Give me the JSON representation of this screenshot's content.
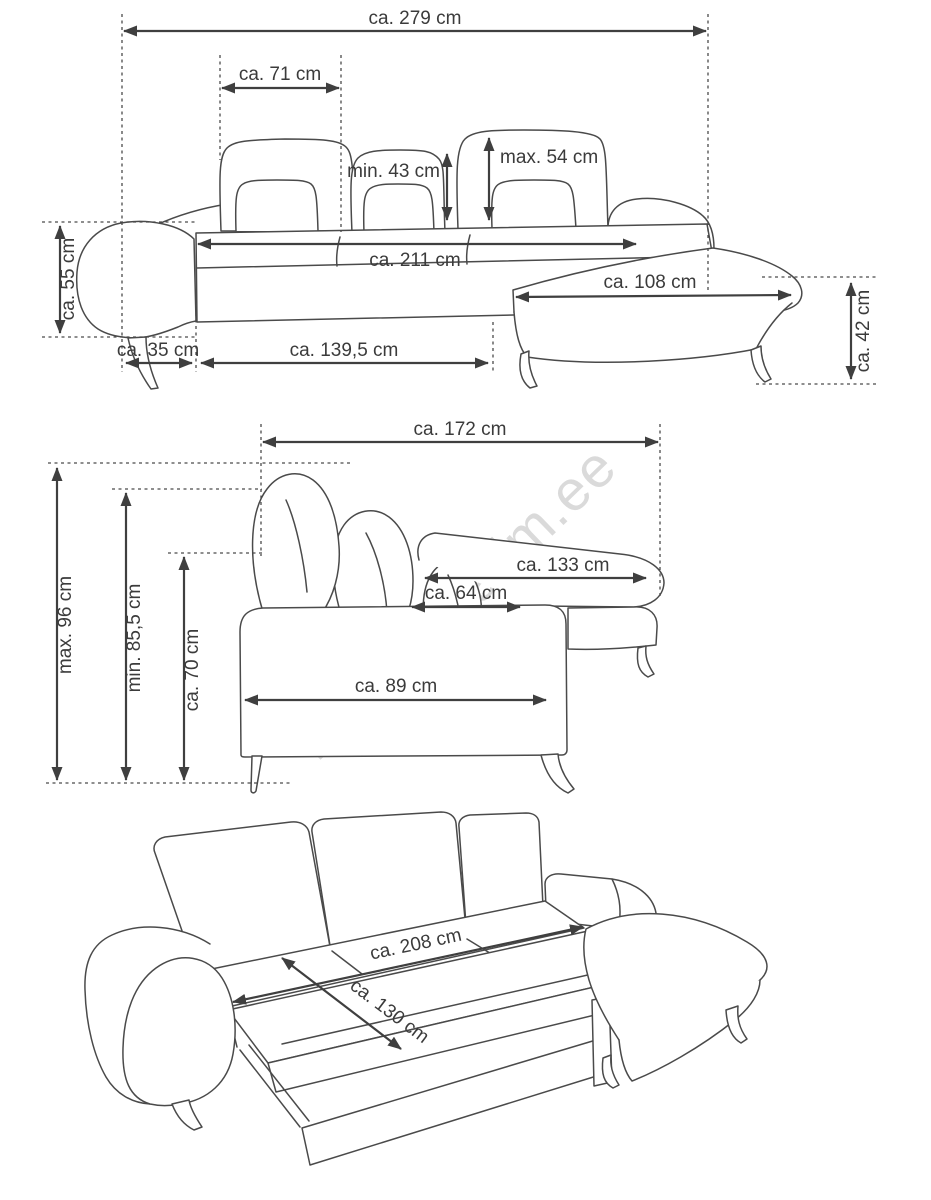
{
  "watermark": {
    "text": "lambimaailm.ee"
  },
  "colors": {
    "background": "#ffffff",
    "line": "#4a4a4a",
    "dimension_arrow": "#3f3f3f",
    "text": "#3b3b3b",
    "watermark": "#dadada"
  },
  "views": {
    "front": {
      "name": "front-elevation",
      "dims": {
        "total_width": "ca. 279 cm",
        "back_cushion_width": "ca. 71 cm",
        "headrest_min_height": "min. 43 cm",
        "headrest_max_height": "max. 54 cm",
        "armrest_height": "ca. 55 cm",
        "seat_width": "ca. 211 cm",
        "chaise_width": "ca. 108 cm",
        "seat_height": "ca. 42 cm",
        "armrest_width": "ca. 35 cm",
        "front_section_length": "ca. 139,5 cm"
      }
    },
    "side": {
      "name": "side-elevation",
      "dims": {
        "total_depth": "ca. 172 cm",
        "height_max": "max. 96 cm",
        "height_min": "min. 85,5 cm",
        "backrest_height": "ca. 70 cm",
        "chaise_depth": "ca. 133 cm",
        "seat_depth": "ca. 64 cm",
        "body_depth": "ca. 89 cm"
      }
    },
    "bed": {
      "name": "sofa-bed-unfolded",
      "dims": {
        "bed_length": "ca. 208 cm",
        "bed_width": "ca. 130 cm"
      }
    }
  }
}
